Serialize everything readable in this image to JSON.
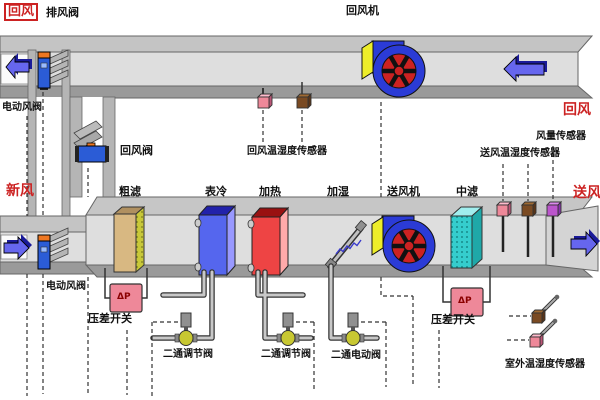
{
  "diagram": {
    "type": "hvac-ahu-schematic",
    "labels": {
      "return_air_top_left": "回风",
      "exhaust_damper": "排风阀",
      "return_fan": "回风机",
      "return_air_right": "回风",
      "motor_damper_top": "电动风阀",
      "return_damper": "回风阀",
      "fresh_air": "新风",
      "coarse_filter": "粗滤",
      "cooling_coil": "表冷",
      "heating_coil": "加热",
      "humidifier": "加湿",
      "supply_fan": "送风机",
      "medium_filter": "中滤",
      "return_temp_humidity_sensor": "回风温湿度传感器",
      "supply_temp_humidity_sensor": "送风温湿度传感器",
      "airflow_sensor": "风量传感器",
      "supply_air": "送风",
      "motor_damper_bottom": "电动风阀",
      "dp_switch_left": "压差开关",
      "dp_switch_right": "压差开关",
      "dp_symbol_left": "ΔP",
      "dp_symbol_right": "ΔP",
      "two_way_regulating_valve_1": "二通调节阀",
      "two_way_regulating_valve_2": "二通调节阀",
      "two_way_motor_valve": "二通电动阀",
      "outdoor_temp_humidity_sensor": "室外温湿度传感器"
    },
    "colors": {
      "red_label": "#cc2222",
      "duct_front": "#dedede",
      "duct_top": "#c4c4c4",
      "duct_bottom": "#9a9a9a",
      "arrow_blue": "#5b5bee",
      "fan_body": "#2b3bd6",
      "fan_rotor": "#cc2222",
      "fan_panel": "#eded2a",
      "cooling_coil": "#5566ee",
      "heating_coil": "#ee4444",
      "coarse_filter": "#d8b882",
      "medium_filter": "#35cdcd",
      "dp_box": "#ee8899",
      "damper_body": "#2b5cd6",
      "damper_cap": "#ee7722",
      "ball_valve": "#c8c832"
    }
  }
}
